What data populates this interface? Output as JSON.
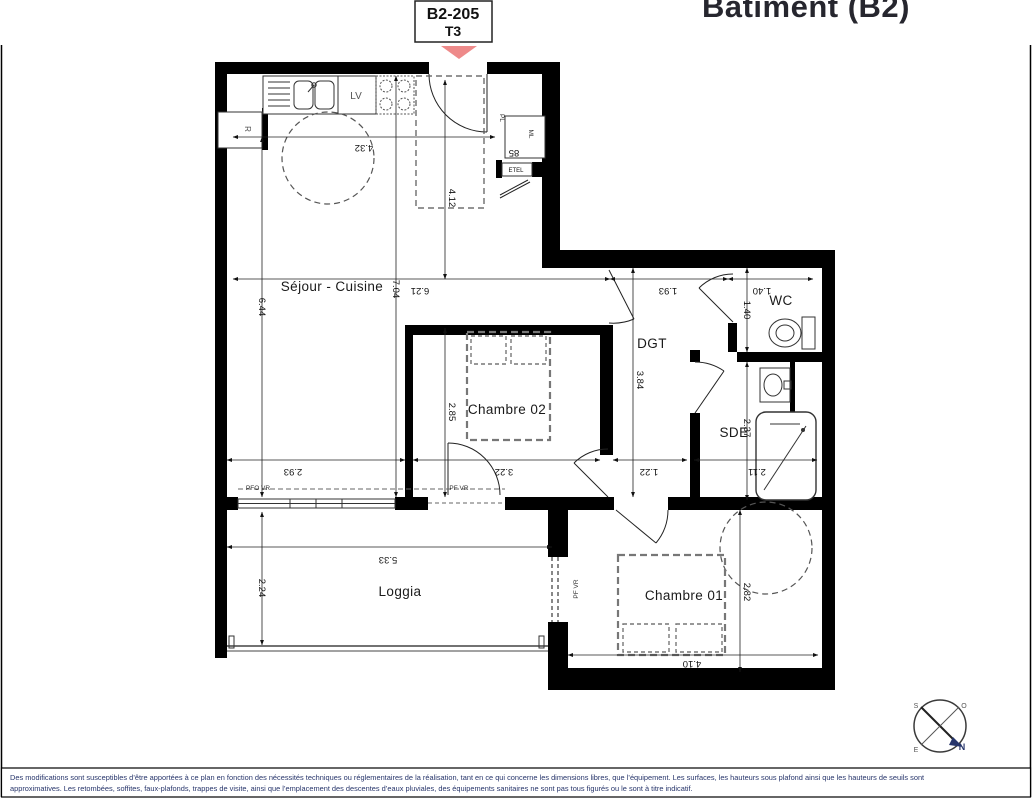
{
  "header": {
    "unit_number": "B2-205",
    "unit_type": "T3",
    "building_title": "Bâtiment (B2)"
  },
  "colors": {
    "accent_pink": "#ee8a8a",
    "text_navy": "#27356b",
    "wall_black": "#000000"
  },
  "footer": {
    "line1": "Des modifications sont susceptibles d’être apportées à ce plan en fonction des nécessités techniques ou réglementaires de la réalisation, tant en ce qui concerne les dimensions libres, que l’équipement. Les surfaces, les hauteurs sous plafond ainsi que les hauteurs de seuils sont",
    "line2": "approximatives. Les retombées, soffites, faux-plafonds, trappes de visite, ainsi que l’emplacement des descentes d’eaux pluviales, des équipements sanitaires ne sont pas tous figurés ou le sont à titre indicatif."
  },
  "plan": {
    "rooms": [
      {
        "name": "sejour-cuisine",
        "text": "Séjour - Cuisine",
        "x": 332,
        "y": 291,
        "s": 13.5
      },
      {
        "name": "chambre-02",
        "text": "Chambre 02",
        "x": 507,
        "y": 414,
        "s": 13.5
      },
      {
        "name": "chambre-01",
        "text": "Chambre 01",
        "x": 684,
        "y": 600,
        "s": 13.5
      },
      {
        "name": "loggia",
        "text": "Loggia",
        "x": 400,
        "y": 596,
        "s": 13.5
      },
      {
        "name": "wc",
        "text": "WC",
        "x": 781,
        "y": 305,
        "s": 13.5
      },
      {
        "name": "dgt",
        "text": "DGT",
        "x": 652,
        "y": 348,
        "s": 13.5
      },
      {
        "name": "sde",
        "text": "SDE",
        "x": 734,
        "y": 437,
        "s": 13.5
      }
    ],
    "dim_labels": [
      {
        "t": "4.32",
        "x": 364,
        "y": 145,
        "r": 180
      },
      {
        "t": "4.12",
        "x": 449,
        "y": 198,
        "r": 90
      },
      {
        "t": "6.44",
        "x": 259,
        "y": 307,
        "r": 90
      },
      {
        "t": "7.04",
        "x": 393,
        "y": 289,
        "r": 90
      },
      {
        "t": "6.21",
        "x": 420,
        "y": 288,
        "r": 180
      },
      {
        "t": "1.93",
        "x": 668,
        "y": 288,
        "r": 180
      },
      {
        "t": "1.40",
        "x": 762,
        "y": 288,
        "r": 180
      },
      {
        "t": "1.40",
        "x": 744,
        "y": 310,
        "r": 90
      },
      {
        "t": "3.84",
        "x": 637,
        "y": 380,
        "r": 90
      },
      {
        "t": "2.85",
        "x": 449,
        "y": 412,
        "r": 90
      },
      {
        "t": "2.37",
        "x": 744,
        "y": 428,
        "r": 90
      },
      {
        "t": "2.93",
        "x": 293,
        "y": 469,
        "r": 180
      },
      {
        "t": "3.22",
        "x": 504,
        "y": 469,
        "r": 180
      },
      {
        "t": "1.22",
        "x": 649,
        "y": 469,
        "r": 180
      },
      {
        "t": "2.11",
        "x": 757,
        "y": 469,
        "r": 180
      },
      {
        "t": "5.33",
        "x": 388,
        "y": 557,
        "r": 180
      },
      {
        "t": "2.24",
        "x": 259,
        "y": 588,
        "r": 90
      },
      {
        "t": "2.82",
        "x": 744,
        "y": 592,
        "r": 90
      },
      {
        "t": "4.10",
        "x": 692,
        "y": 661,
        "r": 180
      },
      {
        "t": "85",
        "x": 514,
        "y": 150,
        "r": 180
      }
    ],
    "dim_lines": [
      [
        233,
        137,
        495,
        137
      ],
      [
        233,
        279,
        610,
        279
      ],
      [
        610,
        279,
        728,
        279
      ],
      [
        728,
        279,
        813,
        279
      ],
      [
        227,
        460,
        405,
        460
      ],
      [
        413,
        460,
        600,
        460
      ],
      [
        613,
        460,
        687,
        460
      ],
      [
        694,
        460,
        817,
        460
      ],
      [
        262,
        137,
        262,
        497
      ],
      [
        262,
        512,
        262,
        645
      ],
      [
        396,
        76,
        396,
        497
      ],
      [
        445,
        80,
        445,
        279
      ],
      [
        445,
        328,
        445,
        497
      ],
      [
        633,
        268,
        633,
        497
      ],
      [
        747,
        268,
        747,
        352
      ],
      [
        747,
        362,
        747,
        500
      ],
      [
        740,
        510,
        740,
        672
      ],
      [
        227,
        547,
        552,
        547
      ],
      [
        568,
        655,
        818,
        655
      ]
    ],
    "labels": [
      {
        "name": "dishwasher-label",
        "t": "LV",
        "x": 356,
        "y": 99,
        "s": 10,
        "c": "#555"
      },
      {
        "name": "fridge-label",
        "t": "R",
        "x": 245,
        "y": 129,
        "s": 8,
        "c": "#555",
        "r": 90
      },
      {
        "name": "closet-label",
        "t": "PL",
        "x": 500,
        "y": 118,
        "s": 6.5,
        "c": "#333",
        "r": 90
      },
      {
        "name": "washer-label",
        "t": "ML",
        "x": 529,
        "y": 134,
        "s": 6.5,
        "c": "#333",
        "r": 90
      },
      {
        "name": "etel-label",
        "t": "ETEL",
        "x": 516,
        "y": 172,
        "s": 6,
        "c": "#111"
      },
      {
        "name": "window-pfo-vr-label",
        "t": "PFO VR",
        "x": 258,
        "y": 490,
        "s": 6.5,
        "c": "#333"
      },
      {
        "name": "window-pf-vr-sejour-label",
        "t": "PF VR",
        "x": 459,
        "y": 490,
        "s": 6.5,
        "c": "#333"
      },
      {
        "name": "window-pf-vr-chambre01-label",
        "t": "PF VR",
        "x": 578,
        "y": 589,
        "s": 6.5,
        "c": "#333",
        "r": -90
      },
      {
        "name": "compass-letter-s",
        "t": "S",
        "x": 916,
        "y": 708,
        "s": 7,
        "c": "#555"
      },
      {
        "name": "compass-letter-o",
        "t": "O",
        "x": 964,
        "y": 708,
        "s": 7,
        "c": "#555"
      },
      {
        "name": "compass-letter-e",
        "t": "E",
        "x": 916,
        "y": 752,
        "s": 7,
        "c": "#555"
      },
      {
        "name": "compass-letter-n",
        "t": "N",
        "x": 962,
        "y": 750,
        "s": 9,
        "c": "#27356b",
        "w": "bold"
      }
    ]
  }
}
